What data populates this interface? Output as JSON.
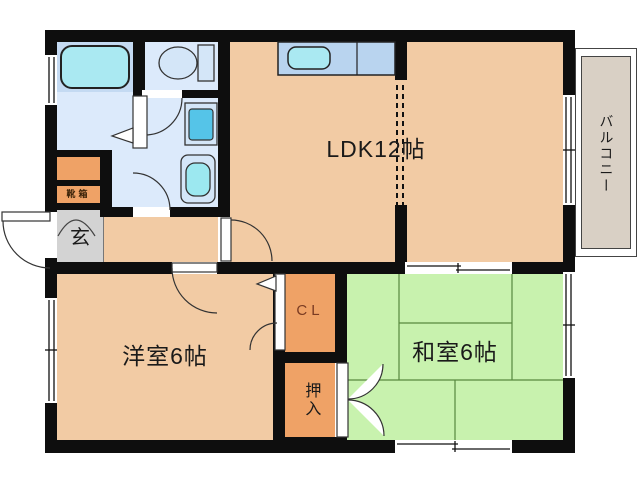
{
  "plan_type": "apartment-floor-plan",
  "rooms": {
    "ldk": {
      "label": "LDK12帖",
      "color": "#f2cba4"
    },
    "western_room": {
      "label": "洋室6帖",
      "color": "#f2cba4"
    },
    "japanese_room": {
      "label": "和室6帖",
      "color": "#c8f2ae"
    },
    "balcony": {
      "label": "バルコニー",
      "color": "#d9d0c5"
    },
    "entrance": {
      "label": "玄",
      "color": "#d3d3d3"
    },
    "shoe_box": {
      "label": "靴箱",
      "color": "#efa266"
    },
    "closet": {
      "label": "CL",
      "color": "#efa266",
      "text_color": "#7a3b22"
    },
    "oshiire": {
      "label": "押入",
      "color": "#efa266"
    }
  },
  "fixtures": [
    "bathtub",
    "toilet",
    "washing-machine",
    "washbasin",
    "kitchen-sink-counter"
  ],
  "symbols": [
    "swing-door-arc",
    "folding-door-triangle",
    "double-door-oshiire",
    "sliding-window",
    "dashed-room-partition",
    "tatami-mat-lines"
  ],
  "colors": {
    "wall": "#0e0e0e",
    "main_floor": "#f2cba4",
    "tatami_green": "#c8f2ae",
    "closet_orange": "#efa266",
    "entrance_gray": "#d3d3d3",
    "bathroom_panel": "#c4daf2",
    "washroom_blue": "#dceafb",
    "fixture_cyan": "#aae9f2",
    "washer_inner": "#55c4e8",
    "counter_blue": "#b9d4ef",
    "balcony_floor": "#d9d0c5",
    "tatami_line": "#57893f"
  }
}
